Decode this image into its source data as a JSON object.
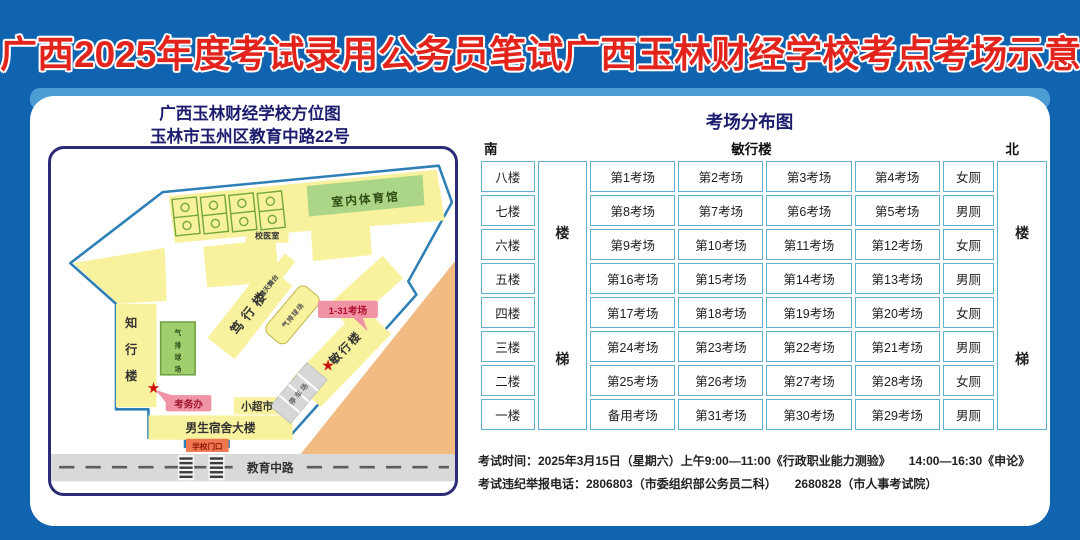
{
  "page_title": "广西2025年度考试录用公务员笔试广西玉林财经学校考点考场示意图",
  "colors": {
    "background_blue": "#1063ae",
    "title_red": "#e3241d",
    "heading_navy": "#1c1c6e",
    "table_border_teal": "#5fb0cd",
    "building_yellow": "#f8f29e",
    "gym_green": "#abd687",
    "court_green": "#9fcf6d",
    "label_pink": "#ef93a5",
    "gate_orange": "#ee7950",
    "offsite_orange": "#f2bb82",
    "road_gray": "#d9d9d9",
    "star_red": "#cc1111"
  },
  "icons": {
    "star": "★"
  },
  "map": {
    "title_line1": "广西玉林财经学校方位图",
    "title_line2": "玉林市玉州区教育中路22号",
    "labels": {
      "gym": "室内体育馆",
      "clinic": "校医室",
      "zhixing": "知行楼",
      "duxing": "笃行楼",
      "minxing": "敏行楼",
      "stage": "露天舞台",
      "volleyball_court": "气排球场",
      "small_court": "气排球场",
      "exam_office": "考务办",
      "rooms_range": "1-31考场",
      "mini_market": "小超市",
      "male_dorm": "男生宿舍大楼",
      "parking": "停车场",
      "gate": "学校门口",
      "road": "教育中路"
    }
  },
  "distribution": {
    "title": "考场分布图",
    "south": "南",
    "north": "北",
    "building_top": "敏行楼",
    "stair_chars": [
      "楼",
      "梯"
    ],
    "floors": [
      {
        "floor": "八楼",
        "rooms": [
          "第1考场",
          "第2考场",
          "第3考场",
          "第4考场"
        ],
        "toilet": "女厕"
      },
      {
        "floor": "七楼",
        "rooms": [
          "第8考场",
          "第7考场",
          "第6考场",
          "第5考场"
        ],
        "toilet": "男厕"
      },
      {
        "floor": "六楼",
        "rooms": [
          "第9考场",
          "第10考场",
          "第11考场",
          "第12考场"
        ],
        "toilet": "女厕"
      },
      {
        "floor": "五楼",
        "rooms": [
          "第16考场",
          "第15考场",
          "第14考场",
          "第13考场"
        ],
        "toilet": "男厕"
      },
      {
        "floor": "四楼",
        "rooms": [
          "第17考场",
          "第18考场",
          "第19考场",
          "第20考场"
        ],
        "toilet": "女厕"
      },
      {
        "floor": "三楼",
        "rooms": [
          "第24考场",
          "第23考场",
          "第22考场",
          "第21考场"
        ],
        "toilet": "男厕"
      },
      {
        "floor": "二楼",
        "rooms": [
          "第25考场",
          "第26考场",
          "第27考场",
          "第28考场"
        ],
        "toilet": "女厕"
      },
      {
        "floor": "一楼",
        "rooms": [
          "备用考场",
          "第31考场",
          "第30考场",
          "第29考场"
        ],
        "toilet": "男厕"
      }
    ]
  },
  "footer": {
    "line1": "考试时间：2025年3月15日（星期六）上午9:00—11:00《行政职业能力测验》　　14:00—16:30《申论》",
    "line2": "考试违纪举报电话：2806803（市委组织部公务员二科）　　2680828（市人事考试院）"
  }
}
